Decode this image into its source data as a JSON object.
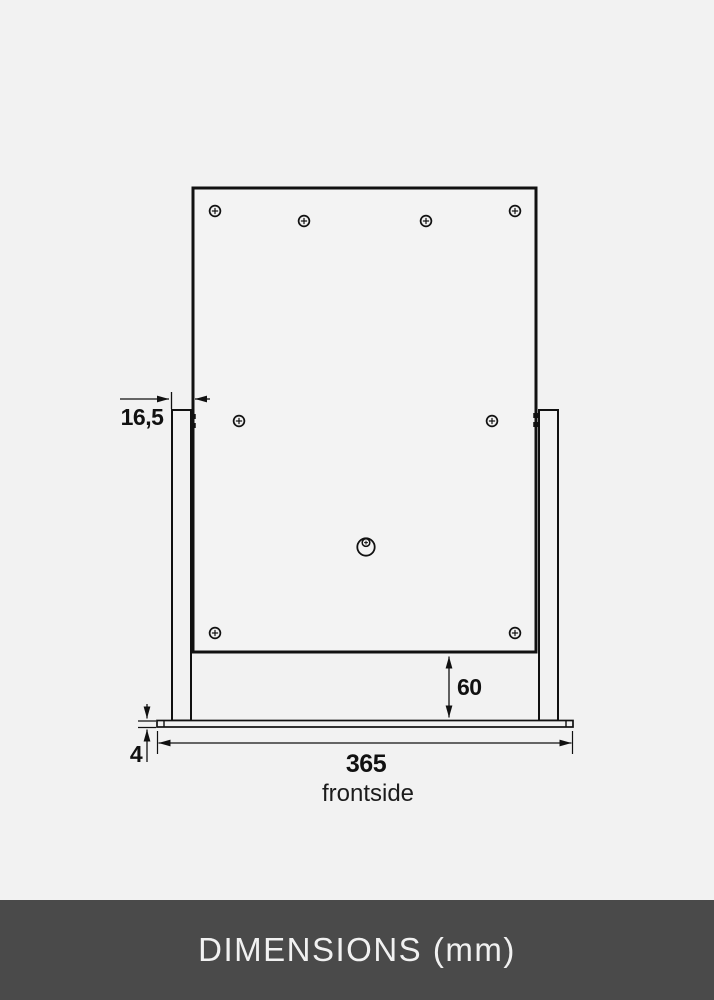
{
  "page": {
    "background_color": "#f2f2f2",
    "line_color": "#111111"
  },
  "drawing": {
    "type": "technical-dimension-drawing",
    "subject": "table-top frame stand, front view",
    "view_label": "frontside",
    "units": "mm",
    "dimensions": {
      "post_to_panel_overlap": "16,5",
      "panel_bottom_to_base_gap": "60",
      "base_plate_thickness": "4",
      "base_plate_width": "365"
    },
    "features": {
      "screw_marker_count": 8,
      "keyhole_hanger_count": 1
    }
  },
  "footer": {
    "title": "DIMENSIONS (mm)",
    "background_color": "#4a4a4a",
    "text_color": "#f1f1f1"
  }
}
